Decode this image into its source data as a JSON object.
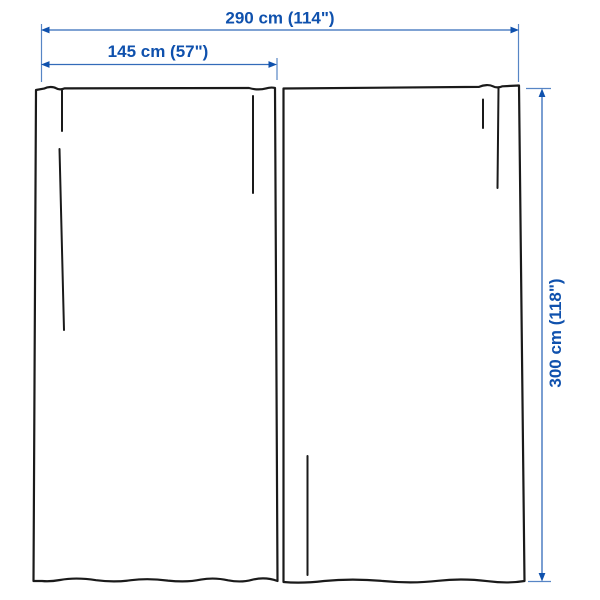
{
  "colors": {
    "dimension-blue": "#0f51ad",
    "outline": "#1a1a1a",
    "background": "#ffffff"
  },
  "dimensions": {
    "total_width": {
      "label": "290 cm (114\")"
    },
    "panel_width": {
      "label": "145 cm (57\")"
    },
    "height": {
      "label": "300 cm (118\")"
    }
  }
}
